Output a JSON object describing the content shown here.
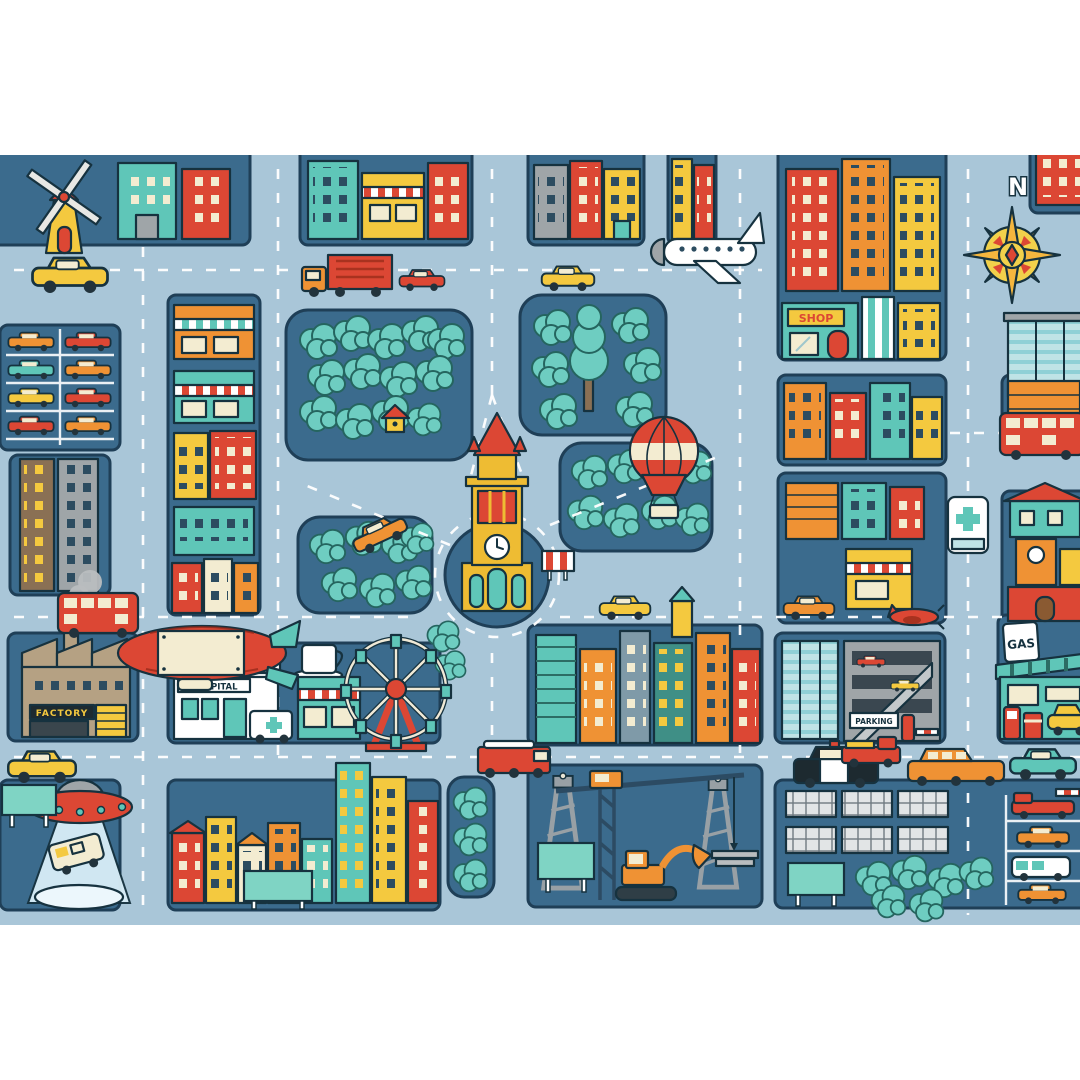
{
  "scene": {
    "type": "illustrated-city-map-poster",
    "description": "Cartoon aerial city map with roads, dark city blocks, teal parks, landmarks and vehicles on a white poster background",
    "background_color": "#ffffff",
    "map_area": {
      "width": 1080,
      "height": 770,
      "top_margin": 155,
      "bottom_margin": 155
    }
  },
  "palette": {
    "road": "#a9c6d8",
    "block": "#3b6b8d",
    "outline": "#16323f",
    "tree": "#6ecdc1",
    "red": "#dc4734",
    "orange": "#ef9234",
    "yellow": "#f4c93f",
    "teal": "#5fc6b8",
    "cream": "#f3ecd1",
    "gray": "#9fa5a8",
    "white": "#ffffff"
  },
  "labels": {
    "compass_north": "N",
    "factory_sign": "FACTORY",
    "hospital_sign": "HOSPITAL",
    "shop_sign": "SHOP",
    "gas_sign": "GAS",
    "parking_sign": "PARKING"
  },
  "landmarks": [
    {
      "name": "windmill"
    },
    {
      "name": "compass-rose"
    },
    {
      "name": "airplane"
    },
    {
      "name": "hot-air-balloon"
    },
    {
      "name": "zeppelin"
    },
    {
      "name": "ufo-abducting-van"
    },
    {
      "name": "ferris-wheel"
    },
    {
      "name": "coffee-shop"
    },
    {
      "name": "factory"
    },
    {
      "name": "hospital"
    },
    {
      "name": "cathedral-clock-tower"
    },
    {
      "name": "roundabout"
    },
    {
      "name": "city-parks"
    },
    {
      "name": "parking-garage"
    },
    {
      "name": "gas-station"
    },
    {
      "name": "construction-site"
    },
    {
      "name": "solar-panel-farm"
    },
    {
      "name": "shop"
    },
    {
      "name": "parking-lot"
    },
    {
      "name": "downtown-skyscrapers"
    }
  ],
  "vehicles": [
    {
      "name": "taxi"
    },
    {
      "name": "cargo-truck"
    },
    {
      "name": "red-car"
    },
    {
      "name": "yellow-car"
    },
    {
      "name": "double-decker-bus"
    },
    {
      "name": "fire-truck"
    },
    {
      "name": "police-car"
    },
    {
      "name": "limousine"
    },
    {
      "name": "pickup-truck"
    },
    {
      "name": "teal-car"
    },
    {
      "name": "ambulance"
    },
    {
      "name": "red-plane"
    },
    {
      "name": "excavator"
    },
    {
      "name": "tower-crane"
    }
  ]
}
